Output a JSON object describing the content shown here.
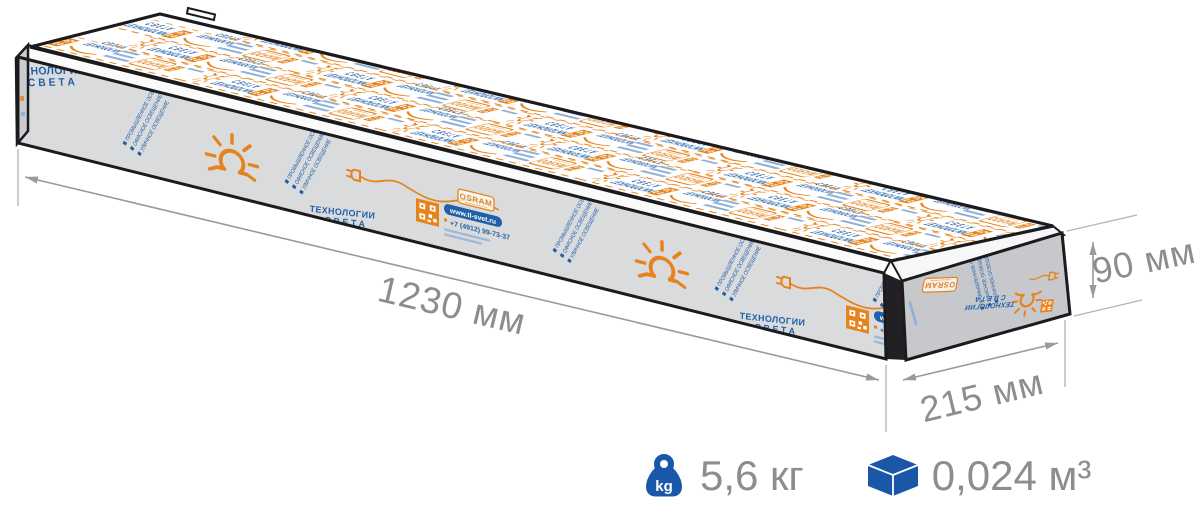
{
  "illustration": {
    "box_print": {
      "brand_line1": "ТЕХНОЛОГИИ",
      "brand_line2": "СВЕТА",
      "partner_label": "OSRAM",
      "website": "www.tl-svet.ru",
      "phone": "+7 (4912) 99-73-37",
      "categories": [
        "ПРОМЫШЛЕННОЕ ОСВЕЩЕНИЕ",
        "ОФИСНОЕ ОСВЕЩЕНИЕ",
        "УЛИЧНОЕ ОСВЕЩЕНИЕ"
      ]
    },
    "dimensions": {
      "length": "1230 мм",
      "depth": "215 мм",
      "height": "90 мм"
    }
  },
  "stats": {
    "weight": {
      "icon": "kettlebell-kg-icon",
      "badge": "kg",
      "value": "5,6 кг"
    },
    "volume": {
      "icon": "cube-icon",
      "value": "0,024 м³"
    }
  },
  "colors": {
    "accent_blue": "#1b57a8",
    "print_orange": "#e6831c",
    "print_blue": "#2060a8",
    "text_gray": "#8d8d8d",
    "line_gray": "#9a9a9a"
  }
}
